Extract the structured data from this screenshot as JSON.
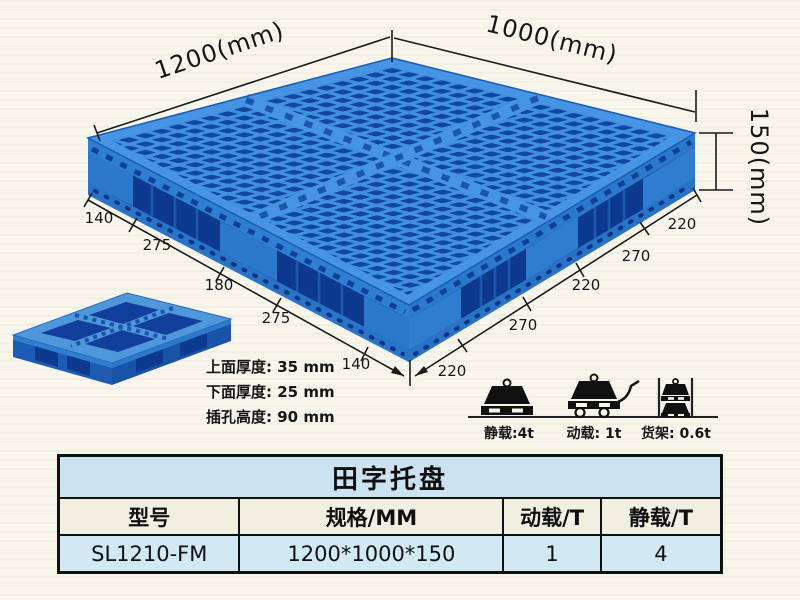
{
  "diagram": {
    "length_label": "1200(mm)",
    "width_label": "1000(mm)",
    "height_label": "150(mm)",
    "left_edge_segments": [
      "140",
      "275",
      "180",
      "275",
      "140"
    ],
    "right_edge_segments": [
      "220",
      "270",
      "220",
      "270",
      "220"
    ],
    "thickness_notes": [
      "上面厚度: 35 mm",
      "下面厚度: 25 mm",
      "插孔高度: 90 mm"
    ],
    "load_ratings": [
      {
        "icon": "static-load-icon",
        "label": "静载:4t"
      },
      {
        "icon": "dynamic-load-icon",
        "label": "动载: 1t"
      },
      {
        "icon": "rack-load-icon",
        "label": "货架: 0.6t"
      }
    ]
  },
  "table": {
    "title": "田字托盘",
    "headers": [
      "型号",
      "规格/MM",
      "动载/T",
      "静载/T"
    ],
    "rows": [
      {
        "model": "SL1210-FM",
        "spec": "1200*1000*150",
        "dynamic_load": "1",
        "static_load": "4"
      }
    ]
  },
  "colors": {
    "pallet_top": "#4090de",
    "pallet_hole": "#1246a5",
    "pallet_gap": "#0d3a8e",
    "pallet_leg": "#2c79cc",
    "dimension_ink": "#1a1a1a",
    "page_bg": "#f8f6ec",
    "table_title_bg": "#cbe3f0",
    "table_header_bg": "#f1eee2",
    "table_row_bg": "#d2e9f4",
    "table_border": "#101010"
  }
}
